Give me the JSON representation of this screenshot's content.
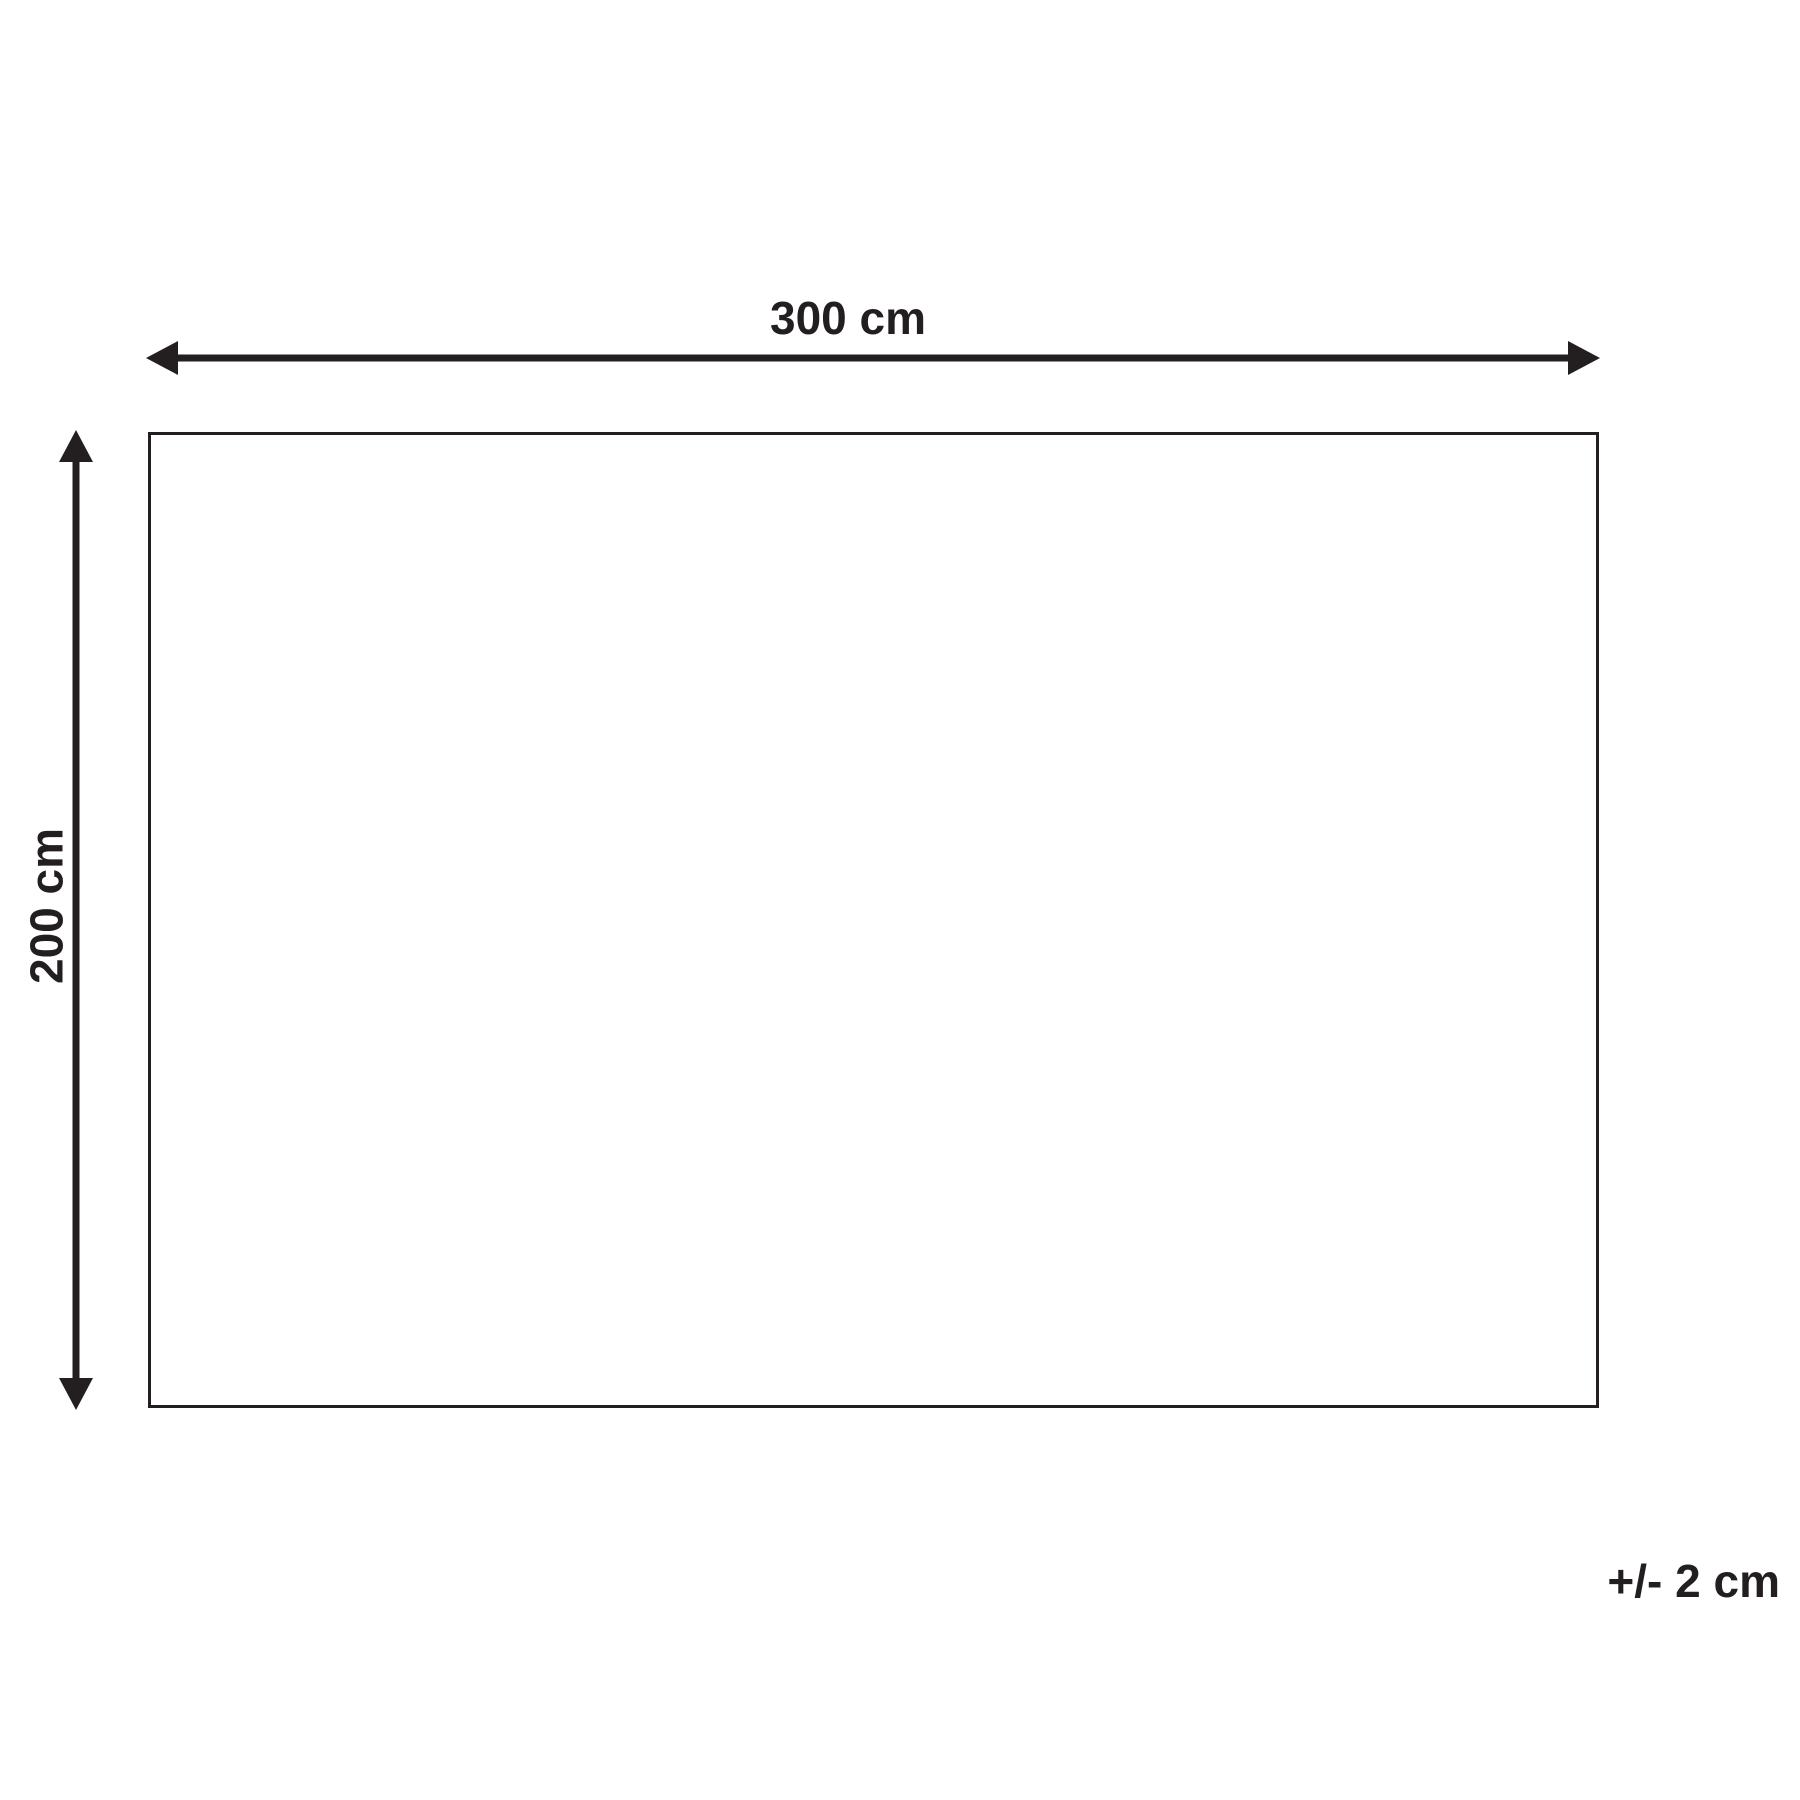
{
  "diagram": {
    "width_label": "300 cm",
    "height_label": "200 cm",
    "tolerance_label": "+/- 2 cm"
  },
  "colors": {
    "line": "#231f20",
    "background": "#ffffff"
  }
}
